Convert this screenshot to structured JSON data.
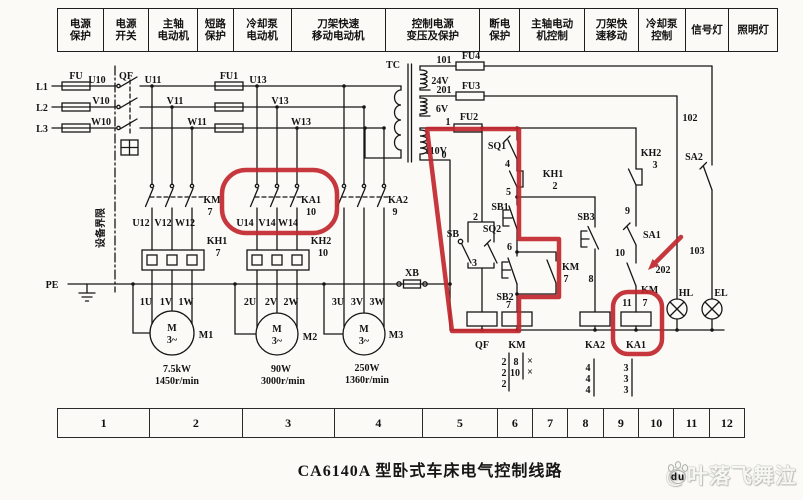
{
  "title": "CA6140A 型卧式车床电气控制线路",
  "watermark": {
    "text": "@叶落飞舞泣",
    "paw_text": "du"
  },
  "colors": {
    "ink": "#161616",
    "annotation_red": "#c1272d",
    "paper": "#fbfaf7"
  },
  "header": {
    "columns": [
      {
        "lines": [
          "电源",
          "保护"
        ],
        "w": 44
      },
      {
        "lines": [
          "电源",
          "开关"
        ],
        "w": 44
      },
      {
        "lines": [
          "主轴",
          "电动机"
        ],
        "w": 47
      },
      {
        "lines": [
          "短路",
          "保护"
        ],
        "w": 34
      },
      {
        "lines": [
          "冷却泵",
          "电动机"
        ],
        "w": 56
      },
      {
        "lines": [
          "刀架快速",
          "移动电动机"
        ],
        "w": 92
      },
      {
        "lines": [
          "控制电源",
          "变压及保护"
        ],
        "w": 92
      },
      {
        "lines": [
          "断电",
          "保护"
        ],
        "w": 38
      },
      {
        "lines": [
          "主轴电动",
          "机控制"
        ],
        "w": 63
      },
      {
        "lines": [
          "刀架快",
          "速移动"
        ],
        "w": 52
      },
      {
        "lines": [
          "冷却泵",
          "控制"
        ],
        "w": 45
      },
      {
        "lines": [
          "信号灯"
        ],
        "w": 42
      },
      {
        "lines": [
          "照明灯"
        ],
        "w": 47
      }
    ]
  },
  "footer_strip": {
    "cells": [
      {
        "t": "1",
        "w": 93
      },
      {
        "t": "2",
        "w": 93
      },
      {
        "t": "3",
        "w": 93
      },
      {
        "t": "4",
        "w": 89
      },
      {
        "t": "5",
        "w": 75
      },
      {
        "t": "6",
        "w": 35
      },
      {
        "t": "7",
        "w": 35
      },
      {
        "t": "8",
        "w": 35
      },
      {
        "t": "9",
        "w": 35
      },
      {
        "t": "10",
        "w": 35
      },
      {
        "t": "11",
        "w": 35
      },
      {
        "t": "12",
        "w": 35
      }
    ]
  },
  "schematic_labels": [
    {
      "n": "label-l1",
      "t": "L1",
      "x": 42,
      "y": 90
    },
    {
      "n": "label-l2",
      "t": "L2",
      "x": 42,
      "y": 111
    },
    {
      "n": "label-l3",
      "t": "L3",
      "x": 42,
      "y": 132
    },
    {
      "n": "label-fu",
      "t": "FU",
      "x": 76,
      "y": 79
    },
    {
      "n": "label-u10",
      "t": "U10",
      "x": 97,
      "y": 83
    },
    {
      "n": "label-v10",
      "t": "V10",
      "x": 101,
      "y": 104
    },
    {
      "n": "label-w10",
      "t": "W10",
      "x": 101,
      "y": 125
    },
    {
      "n": "label-qf-switch",
      "t": "QF",
      "x": 126,
      "y": 79
    },
    {
      "n": "label-u11",
      "t": "U11",
      "x": 153,
      "y": 83
    },
    {
      "n": "label-v11",
      "t": "V11",
      "x": 175,
      "y": 104
    },
    {
      "n": "label-w11",
      "t": "W11",
      "x": 197,
      "y": 125
    },
    {
      "n": "label-fu1",
      "t": "FU1",
      "x": 229,
      "y": 79
    },
    {
      "n": "label-u13",
      "t": "U13",
      "x": 258,
      "y": 83
    },
    {
      "n": "label-v13",
      "t": "V13",
      "x": 280,
      "y": 104
    },
    {
      "n": "label-w13",
      "t": "W13",
      "x": 301,
      "y": 125
    },
    {
      "n": "label-tc",
      "t": "TC",
      "x": 393,
      "y": 68
    },
    {
      "n": "label-equipment-boundary",
      "t": "设备界限",
      "x": 104,
      "y": 228,
      "r": -90,
      "s": 11
    },
    {
      "n": "label-km-contacts",
      "t": "KM",
      "x": 212,
      "y": 203
    },
    {
      "n": "label-km-contacts-7",
      "t": "7",
      "x": 210,
      "y": 215
    },
    {
      "n": "label-u12",
      "t": "U12",
      "x": 141,
      "y": 226
    },
    {
      "n": "label-v12",
      "t": "V12",
      "x": 163,
      "y": 226
    },
    {
      "n": "label-w12",
      "t": "W12",
      "x": 185,
      "y": 226
    },
    {
      "n": "label-ka1-contacts",
      "t": "KA1",
      "x": 311,
      "y": 203
    },
    {
      "n": "label-ka1-contacts-10",
      "t": "10",
      "x": 311,
      "y": 215
    },
    {
      "n": "label-u14",
      "t": "U14",
      "x": 245,
      "y": 226
    },
    {
      "n": "label-v14",
      "t": "V14",
      "x": 267,
      "y": 226
    },
    {
      "n": "label-w14",
      "t": "W14",
      "x": 288,
      "y": 226
    },
    {
      "n": "label-ka2-contacts",
      "t": "KA2",
      "x": 398,
      "y": 203
    },
    {
      "n": "label-ka2-contacts-9",
      "t": "9",
      "x": 395,
      "y": 215
    },
    {
      "n": "label-kh1-heater",
      "t": "KH1",
      "x": 217,
      "y": 244
    },
    {
      "n": "label-kh1-heater-7",
      "t": "7",
      "x": 218,
      "y": 256
    },
    {
      "n": "label-kh2-heater",
      "t": "KH2",
      "x": 321,
      "y": 244
    },
    {
      "n": "label-kh2-heater-10",
      "t": "10",
      "x": 323,
      "y": 256
    },
    {
      "n": "label-pe",
      "t": "PE",
      "x": 52,
      "y": 288
    },
    {
      "n": "label-xb",
      "t": "XB",
      "x": 412,
      "y": 276
    },
    {
      "n": "label-1u",
      "t": "1U",
      "x": 146,
      "y": 305
    },
    {
      "n": "label-1v",
      "t": "1V",
      "x": 166,
      "y": 305
    },
    {
      "n": "label-1w",
      "t": "1W",
      "x": 186,
      "y": 305
    },
    {
      "n": "label-2u",
      "t": "2U",
      "x": 250,
      "y": 305
    },
    {
      "n": "label-2v",
      "t": "2V",
      "x": 271,
      "y": 305
    },
    {
      "n": "label-2w",
      "t": "2W",
      "x": 291,
      "y": 305
    },
    {
      "n": "label-3u",
      "t": "3U",
      "x": 338,
      "y": 305
    },
    {
      "n": "label-3v",
      "t": "3V",
      "x": 357,
      "y": 305
    },
    {
      "n": "label-3w",
      "t": "3W",
      "x": 377,
      "y": 305
    },
    {
      "n": "label-m1-letter",
      "t": "M",
      "x": 172,
      "y": 331,
      "s": 11
    },
    {
      "n": "label-m1-phase",
      "t": "3~",
      "x": 172,
      "y": 343
    },
    {
      "n": "label-m1",
      "t": "M1",
      "x": 206,
      "y": 338
    },
    {
      "n": "label-m2-letter",
      "t": "M",
      "x": 277,
      "y": 332,
      "s": 11
    },
    {
      "n": "label-m2-phase",
      "t": "3~",
      "x": 277,
      "y": 344
    },
    {
      "n": "label-m2",
      "t": "M2",
      "x": 310,
      "y": 340
    },
    {
      "n": "label-m3-letter",
      "t": "M",
      "x": 364,
      "y": 332,
      "s": 11
    },
    {
      "n": "label-m3-phase",
      "t": "3~",
      "x": 364,
      "y": 344
    },
    {
      "n": "label-m3",
      "t": "M3",
      "x": 396,
      "y": 338
    },
    {
      "n": "label-m1-power",
      "t": "7.5kW",
      "x": 177,
      "y": 372
    },
    {
      "n": "label-m1-speed",
      "t": "1450r/min",
      "x": 177,
      "y": 384
    },
    {
      "n": "label-m2-power",
      "t": "90W",
      "x": 281,
      "y": 372
    },
    {
      "n": "label-m2-speed",
      "t": "3000r/min",
      "x": 283,
      "y": 384
    },
    {
      "n": "label-m3-power",
      "t": "250W",
      "x": 367,
      "y": 371
    },
    {
      "n": "label-m3-speed",
      "t": "1360r/min",
      "x": 367,
      "y": 383
    },
    {
      "n": "label-wire-101",
      "t": "101",
      "x": 444,
      "y": 63
    },
    {
      "n": "label-fu4",
      "t": "FU4",
      "x": 471,
      "y": 59
    },
    {
      "n": "label-24v",
      "t": "24V",
      "x": 440,
      "y": 84
    },
    {
      "n": "label-wire-201",
      "t": "201",
      "x": 444,
      "y": 93
    },
    {
      "n": "label-fu3",
      "t": "FU3",
      "x": 471,
      "y": 89
    },
    {
      "n": "label-6v",
      "t": "6V",
      "x": 442,
      "y": 112
    },
    {
      "n": "label-wire-1",
      "t": "1",
      "x": 448,
      "y": 125
    },
    {
      "n": "label-fu2",
      "t": "FU2",
      "x": 469,
      "y": 120
    },
    {
      "n": "label-110v",
      "t": "110V",
      "x": 436,
      "y": 154
    },
    {
      "n": "label-wire-0",
      "t": "0",
      "x": 444,
      "y": 158
    },
    {
      "n": "label-sq1",
      "t": "SQ1",
      "x": 497,
      "y": 149
    },
    {
      "n": "label-wire-4",
      "t": "4",
      "x": 510,
      "y": 167,
      "a": "end"
    },
    {
      "n": "label-kh1-contact",
      "t": "KH1",
      "x": 553,
      "y": 177
    },
    {
      "n": "label-kh1-contact-2",
      "t": "2",
      "x": 555,
      "y": 189
    },
    {
      "n": "label-wire-5",
      "t": "5",
      "x": 511,
      "y": 195,
      "a": "end"
    },
    {
      "n": "label-sb1",
      "t": "SB1",
      "x": 500,
      "y": 210
    },
    {
      "n": "label-wire-2",
      "t": "2",
      "x": 478,
      "y": 220,
      "a": "end"
    },
    {
      "n": "label-sb",
      "t": "SB",
      "x": 459,
      "y": 237,
      "a": "end"
    },
    {
      "n": "label-sq2",
      "t": "SQ2",
      "x": 492,
      "y": 232
    },
    {
      "n": "label-wire-3",
      "t": "3",
      "x": 477,
      "y": 266,
      "a": "end"
    },
    {
      "n": "label-wire-6",
      "t": "6",
      "x": 512,
      "y": 250,
      "a": "end"
    },
    {
      "n": "label-sb2",
      "t": "SB2",
      "x": 505,
      "y": 300
    },
    {
      "n": "label-km-selflock",
      "t": "KM",
      "x": 562,
      "y": 270,
      "a": "start"
    },
    {
      "n": "label-km-selflock-7",
      "t": "7",
      "x": 566,
      "y": 282
    },
    {
      "n": "label-wire-8",
      "t": "8",
      "x": 591,
      "y": 282
    },
    {
      "n": "label-wire-7-coil",
      "t": "7",
      "x": 511,
      "y": 308,
      "a": "end"
    },
    {
      "n": "label-sb3",
      "t": "SB3",
      "x": 586,
      "y": 220
    },
    {
      "n": "label-kh2-contact",
      "t": "KH2",
      "x": 651,
      "y": 156
    },
    {
      "n": "label-kh2-contact-3",
      "t": "3",
      "x": 655,
      "y": 168
    },
    {
      "n": "label-wire-9",
      "t": "9",
      "x": 630,
      "y": 214,
      "a": "end"
    },
    {
      "n": "label-sa1",
      "t": "SA1",
      "x": 643,
      "y": 238,
      "a": "start"
    },
    {
      "n": "label-wire-10",
      "t": "10",
      "x": 625,
      "y": 256,
      "a": "end"
    },
    {
      "n": "label-km-pump-contact",
      "t": "KM",
      "x": 641,
      "y": 293,
      "a": "start"
    },
    {
      "n": "label-wire-11",
      "t": "11",
      "x": 627,
      "y": 306
    },
    {
      "n": "label-wire-7-ka1",
      "t": "7",
      "x": 645,
      "y": 306
    },
    {
      "n": "label-wire-202",
      "t": "202",
      "x": 663,
      "y": 273
    },
    {
      "n": "label-sa2",
      "t": "SA2",
      "x": 694,
      "y": 160
    },
    {
      "n": "label-wire-102",
      "t": "102",
      "x": 690,
      "y": 121
    },
    {
      "n": "label-wire-103",
      "t": "103",
      "x": 697,
      "y": 254
    },
    {
      "n": "label-hl",
      "t": "HL",
      "x": 686,
      "y": 296
    },
    {
      "n": "label-el",
      "t": "EL",
      "x": 721,
      "y": 296
    },
    {
      "n": "label-qf-coil",
      "t": "QF",
      "x": 482,
      "y": 348,
      "s": 11
    },
    {
      "n": "label-km-coil",
      "t": "KM",
      "x": 517,
      "y": 348,
      "s": 11
    },
    {
      "n": "label-ka2-coil",
      "t": "KA2",
      "x": 595,
      "y": 348,
      "s": 11
    },
    {
      "n": "label-ka1-coil",
      "t": "KA1",
      "x": 636,
      "y": 348,
      "s": 11
    },
    {
      "n": "km-table-2a",
      "t": "2",
      "x": 504,
      "y": 365
    },
    {
      "n": "km-table-2b",
      "t": "2",
      "x": 504,
      "y": 376
    },
    {
      "n": "km-table-2c",
      "t": "2",
      "x": 504,
      "y": 387
    },
    {
      "n": "km-table-8",
      "t": "8",
      "x": 516,
      "y": 365
    },
    {
      "n": "km-table-10",
      "t": "10",
      "x": 515,
      "y": 376
    },
    {
      "n": "km-table-x1",
      "t": "×",
      "x": 530,
      "y": 364
    },
    {
      "n": "km-table-x2",
      "t": "×",
      "x": 530,
      "y": 375
    },
    {
      "n": "ka2-table-4a",
      "t": "4",
      "x": 588,
      "y": 371
    },
    {
      "n": "ka2-table-4b",
      "t": "4",
      "x": 588,
      "y": 382
    },
    {
      "n": "ka2-table-4c",
      "t": "4",
      "x": 588,
      "y": 393
    },
    {
      "n": "ka1-table-3a",
      "t": "3",
      "x": 626,
      "y": 371
    },
    {
      "n": "ka1-table-3b",
      "t": "3",
      "x": 626,
      "y": 382
    },
    {
      "n": "ka1-table-3c",
      "t": "3",
      "x": 626,
      "y": 393
    }
  ]
}
